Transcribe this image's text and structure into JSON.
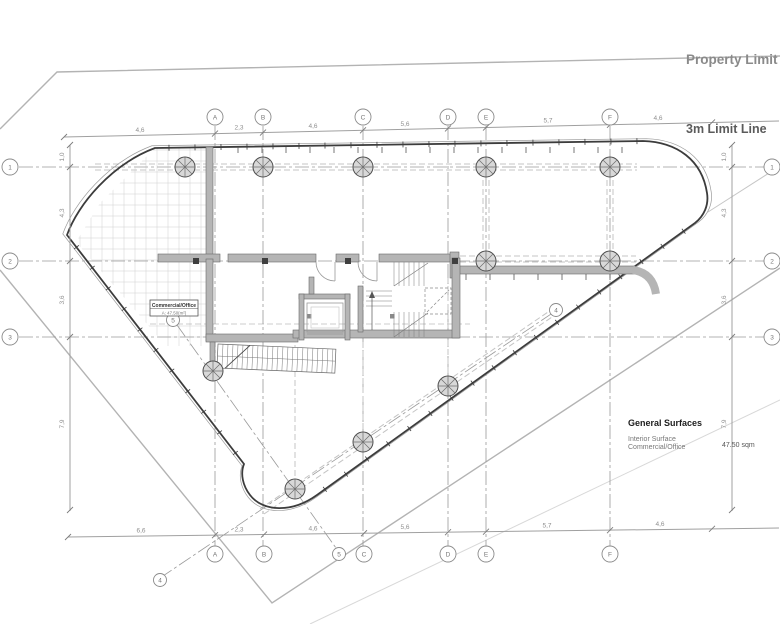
{
  "annotations": {
    "property_limit": "Property Limit",
    "limit_line": "3m Limit Line"
  },
  "legend": {
    "title": "General Surfaces",
    "surface_label": "Interior Surface",
    "surface_sublabel": "Commercial/Office",
    "surface_value": "47.50 sqm"
  },
  "room_tag": {
    "title": "Commercial/Office",
    "area": "A: 47.50(m²)"
  },
  "grid": {
    "top_bubbles": [
      {
        "label": "A",
        "x": 215
      },
      {
        "label": "B",
        "x": 263
      },
      {
        "label": "C",
        "x": 363
      },
      {
        "label": "D",
        "x": 448
      },
      {
        "label": "E",
        "x": 486
      },
      {
        "label": "F",
        "x": 610
      }
    ],
    "bottom_bubbles": [
      {
        "label": "A",
        "x": 215
      },
      {
        "label": "B",
        "x": 264
      },
      {
        "label": "C",
        "x": 364
      },
      {
        "label": "D",
        "x": 448
      },
      {
        "label": "E",
        "x": 486
      },
      {
        "label": "F",
        "x": 610
      }
    ],
    "left_bubbles": [
      {
        "label": "1",
        "y": 167
      },
      {
        "label": "2",
        "y": 261
      },
      {
        "label": "3",
        "y": 337
      }
    ],
    "right_bubbles": [
      {
        "label": "1",
        "y": 167
      },
      {
        "label": "2",
        "y": 261
      },
      {
        "label": "3",
        "y": 337
      }
    ],
    "diagonal_bubbles": [
      {
        "label": "4",
        "x": 160,
        "y": 580
      },
      {
        "label": "4",
        "x": 556,
        "y": 310
      },
      {
        "label": "5",
        "x": 173,
        "y": 320
      },
      {
        "label": "5",
        "x": 339,
        "y": 554
      }
    ]
  },
  "dimensions": {
    "top": [
      {
        "text": "4,6",
        "x": 140
      },
      {
        "text": "2,3",
        "x": 239
      },
      {
        "text": "4,6",
        "x": 313
      },
      {
        "text": "5,6",
        "x": 405
      },
      {
        "text": "5,7",
        "x": 548
      },
      {
        "text": "4,6",
        "x": 658
      }
    ],
    "bottom": [
      {
        "text": "6,6",
        "x": 141
      },
      {
        "text": "2,3",
        "x": 239
      },
      {
        "text": "4,6",
        "x": 313
      },
      {
        "text": "5,6",
        "x": 405
      },
      {
        "text": "5,7",
        "x": 547
      },
      {
        "text": "4,6",
        "x": 660
      }
    ],
    "left": [
      {
        "text": "1,0",
        "y": 157
      },
      {
        "text": "4,3",
        "y": 213
      },
      {
        "text": "3,6",
        "y": 300
      },
      {
        "text": "7,9",
        "y": 424
      }
    ],
    "right": [
      {
        "text": "1,0",
        "y": 157
      },
      {
        "text": "4,3",
        "y": 213
      },
      {
        "text": "3,6",
        "y": 300
      },
      {
        "text": "7,9",
        "y": 424
      }
    ]
  },
  "colors": {
    "wall": "#b5b5b5",
    "wall_edge": "#6a6a6a",
    "envelope": "#3c3c3c",
    "grid_line": "#9a9a9a",
    "beam": "#c4c4c4",
    "property": "#b3b3b3",
    "dimension": "#a0a0a0"
  }
}
